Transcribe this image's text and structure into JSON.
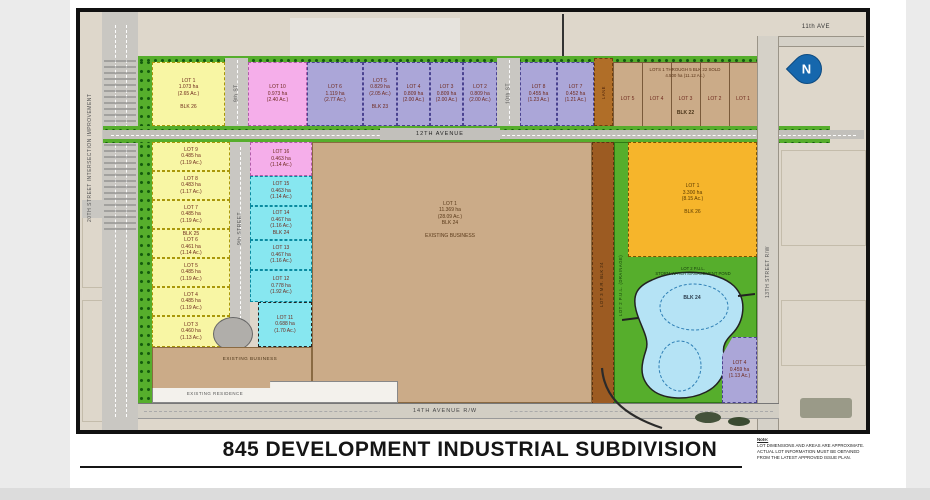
{
  "page": {
    "title": "845 DEVELOPMENT INDUSTRIAL SUBDIVISION",
    "note_heading": "Note:",
    "note_body": "LOT DIMENSIONS AND AREAS ARE APPROXIMATE.\nACTUAL LOT INFORMATION MUST BE OBTAINED\nFROM THE LATEST APPROVED ISSUE PLAN."
  },
  "compass": {
    "letter": "N"
  },
  "roads": {
    "ave11": "11th AVE",
    "ave12": "12TH AVENUE",
    "ave14": "14TH AVENUE R/W",
    "st13": "13TH STREET R/W",
    "st9_upper": "9th ST",
    "st9_lower": "9th STREET",
    "st10": "10th ST",
    "st20": "20TH STREET INTERSECTION IMPROVEMENT",
    "lane": "LANE"
  },
  "areas": {
    "existing_business": "EXISTING BUSINESS",
    "existing_residence": "EXISTING RESIDENCE",
    "mr_strip": "LOT 3 M.R. BLK 24",
    "pul_strip": "LOT 2 P.U.L. (DRAINAGE)"
  },
  "lots": {
    "yellow_blk26": "LOT 1\n1.073 ha\n(2.65 Ac.)\n\nBLK 26",
    "pink_10": "LOT 10\n0.973 ha\n(2.40 Ac.)",
    "purple_row": [
      "LOT 6\n1.119 ha\n(2.77 Ac.)",
      "LOT 5\n0.829 ha\n(2.05 Ac.)\n\nBLK 23",
      "LOT 4\n0.809 ha\n(2.00 Ac.)",
      "LOT 3\n0.809 ha\n(2.00 Ac.)",
      "LOT 2\n0.809 ha\n(2.00 Ac.)"
    ],
    "purple_pair": [
      "LOT 8\n0.455 ha\n(1.23 Ac.)",
      "LOT 7\n0.452 ha\n(1.21 Ac.)"
    ],
    "blk22": {
      "header": "LOTS 1 THROUGH 5 BLK 22 SOLD\n4.500 ha (11.12 Ac.)",
      "names": [
        "LOT 5",
        "LOT 4",
        "LOT 3",
        "LOT 2",
        "LOT 1"
      ],
      "blk": "BLK 22"
    },
    "blk25_column": [
      "LOT 9\n0.485 ha\n(1.19 Ac.)",
      "LOT 8\n0.483 ha\n(1.17 Ac.)",
      "LOT 7\n0.485 ha\n(1.19 Ac.)",
      "BLK 25\nLOT 6\n0.461 ha\n(1.14 Ac.)",
      "LOT 5\n0.485 ha\n(1.19 Ac.)",
      "LOT 4\n0.485 ha\n(1.19 Ac.)",
      "LOT 3\n0.460 ha\n(1.13 Ac.)"
    ],
    "pink_16": "LOT 16\n0.463 ha\n(1.14 Ac.)",
    "cyan_column": [
      "LOT 15\n0.463 ha\n(1.14 Ac.)",
      "LOT 14\n0.467 ha\n(1.16 Ac.)\nBLK 24",
      "LOT 13\n0.467 ha\n(1.16 Ac.)",
      "LOT 12\n0.778 ha\n(1.92 Ac.)",
      "LOT 11\n0.688 ha\n(1.70 Ac.)"
    ],
    "big_blk24": "LOT 1\n11.369 ha\n(28.09 Ac.)\nBLK 24\n\nEXISTING BUSINESS",
    "orange_blk26": "LOT 1\n3.300 ha\n(8.15 Ac.)\n\nBLK 26",
    "pond": {
      "label": "LOT 2 P.U.L.\nSTORM WATER MANAGEMENT POND",
      "blk": "BLK 24"
    },
    "purple_4": "LOT 4\n0.459 ha\n(1.13 Ac.)"
  },
  "colors": {
    "yellow": "#f8f6a4",
    "pink": "#f5aeea",
    "purple": "#aba6d8",
    "cyan": "#87e7f0",
    "tan": "#d0ad89",
    "big_tan": "#cbab88",
    "orange": "#f6b52b",
    "green": "#56ae2c",
    "pond_blue": "#b5e3f5",
    "brown": "#9c5b22",
    "compass_blue": "#1667ad"
  }
}
